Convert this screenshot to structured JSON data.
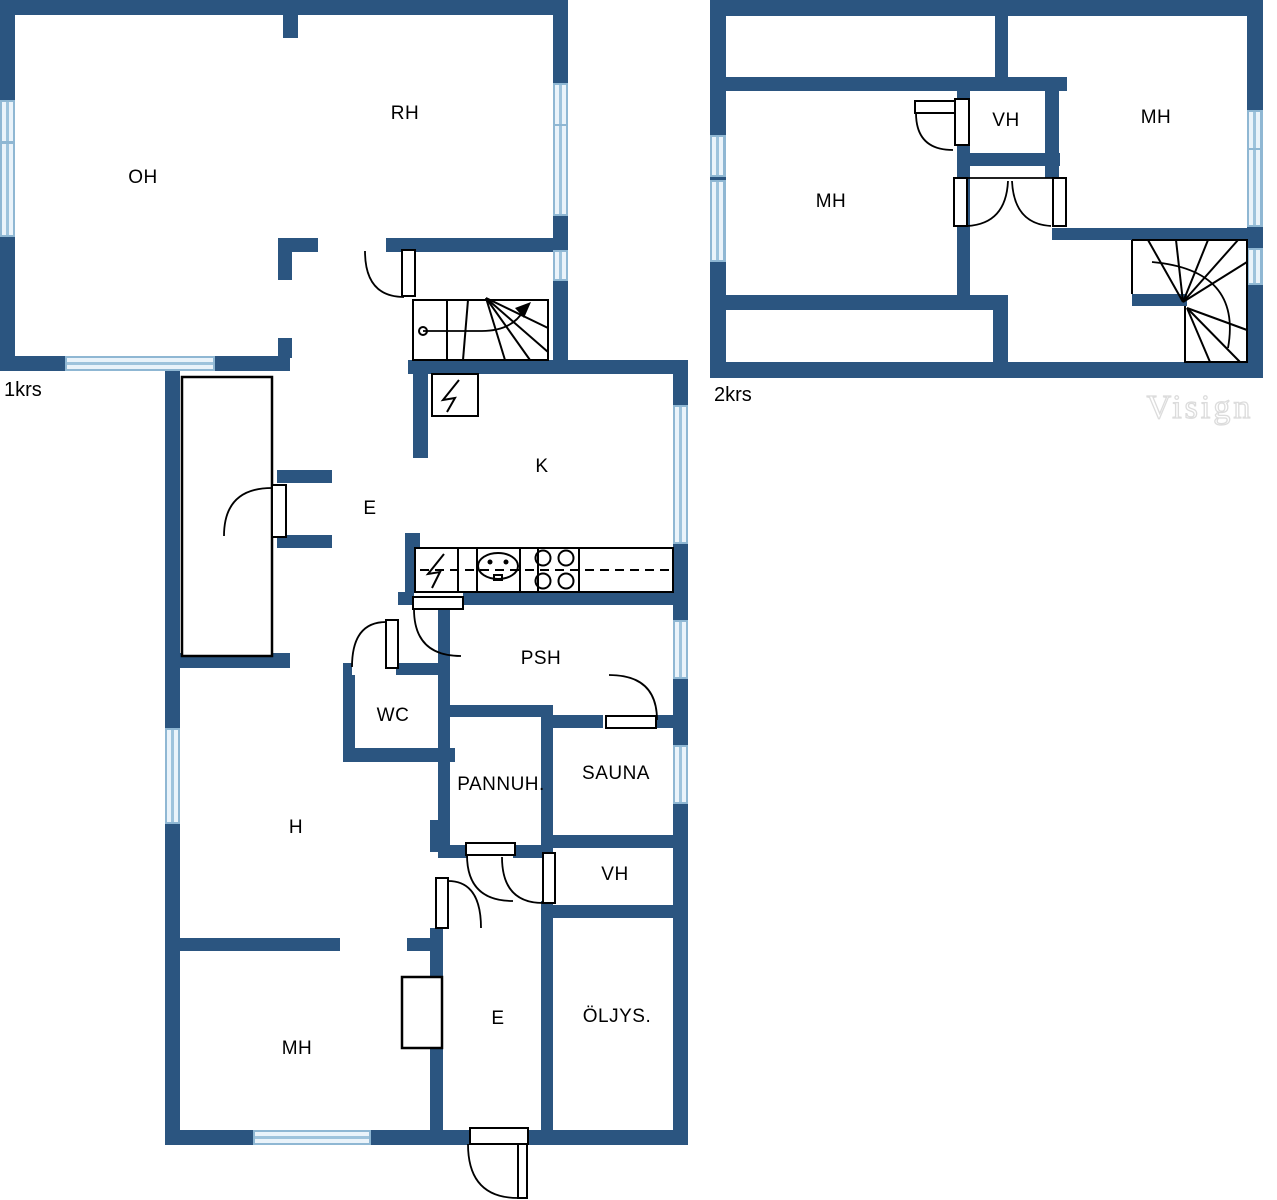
{
  "colors": {
    "wall": "#2B5580",
    "win-edge": "#8FB7D3",
    "win-light": "#EAF3FA",
    "win-mid": "#9EC3DC",
    "line": "#000000",
    "watermark": "#DCDCDC"
  },
  "floors": [
    {
      "label": "1krs",
      "rooms": [
        {
          "name": "OH"
        },
        {
          "name": "RH"
        },
        {
          "name": "K"
        },
        {
          "name": "E"
        },
        {
          "name": "PSH"
        },
        {
          "name": "WC"
        },
        {
          "name": "PANNUH."
        },
        {
          "name": "SAUNA"
        },
        {
          "name": "H"
        },
        {
          "name": "VH"
        },
        {
          "name": "MH"
        },
        {
          "name": "E"
        },
        {
          "name": "ÖLJYS."
        }
      ]
    },
    {
      "label": "2krs",
      "rooms": [
        {
          "name": "MH"
        },
        {
          "name": "VH"
        },
        {
          "name": "MH"
        }
      ]
    }
  ],
  "watermark": "Visign",
  "symbols": {
    "electrical-panel": "lightning-bolt-in-box",
    "stove": "four-burner-circles",
    "sink": "oval-basin",
    "stairs": "winder-treads-with-walk-line",
    "door": "quarter-arc-swing",
    "window": "light-blue-band"
  }
}
